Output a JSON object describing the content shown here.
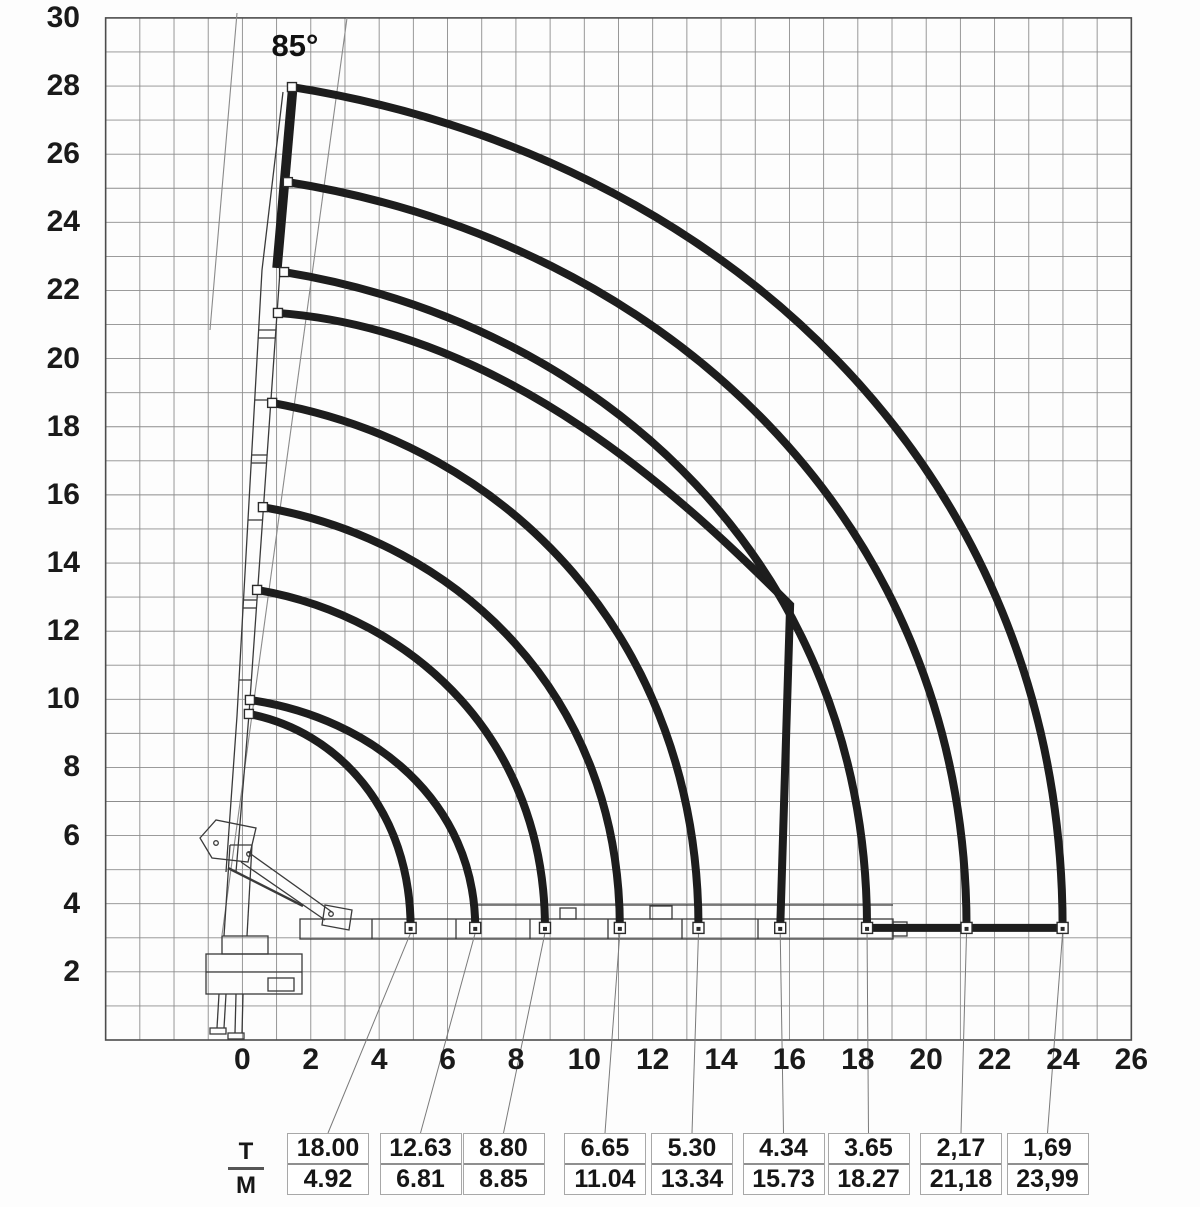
{
  "angle_label": "85°",
  "legend": {
    "numerator": "T",
    "denominator": "M"
  },
  "axes": {
    "x_tick_labels": [
      "0",
      "2",
      "4",
      "6",
      "8",
      "10",
      "12",
      "14",
      "16",
      "18",
      "20",
      "22",
      "24",
      "26"
    ],
    "x_tick_values": [
      0,
      2,
      4,
      6,
      8,
      10,
      12,
      14,
      16,
      18,
      20,
      22,
      24,
      26
    ],
    "y_tick_labels": [
      "30",
      "28",
      "26",
      "24",
      "22",
      "20",
      "18",
      "16",
      "14",
      "12",
      "10",
      "8",
      "6",
      "4",
      "2"
    ],
    "y_tick_values": [
      30,
      28,
      26,
      24,
      22,
      20,
      18,
      16,
      14,
      12,
      10,
      8,
      6,
      4,
      2
    ]
  },
  "chart_data": {
    "type": "line",
    "description": "Loader crane lifting capacity envelope diagram: nested load curves (capacity in tonnes over outreach in metres) for boom raised to 85 degrees",
    "boom_angle_label": "85°",
    "boom_angle_deg": 85,
    "x_range_m": [
      -4,
      26
    ],
    "y_range_m": [
      0,
      30
    ],
    "grid": true,
    "grid_step_m": 1,
    "ground_line_y_m": 3.29,
    "curves": [
      {
        "capacity_t_display": "18.00",
        "outreach_m_display": "4.92",
        "capacity_t": 18.0,
        "outreach_m": 4.92,
        "top_point_m": [
          0.19,
          9.57
        ]
      },
      {
        "capacity_t_display": "12.63",
        "outreach_m_display": "6.81",
        "capacity_t": 12.63,
        "outreach_m": 6.81,
        "top_point_m": [
          0.22,
          9.98
        ]
      },
      {
        "capacity_t_display": "8.80",
        "outreach_m_display": "8.85",
        "capacity_t": 8.8,
        "outreach_m": 8.85,
        "top_point_m": [
          0.43,
          13.21
        ]
      },
      {
        "capacity_t_display": "6.65",
        "outreach_m_display": "11.04",
        "capacity_t": 6.65,
        "outreach_m": 11.04,
        "top_point_m": [
          0.6,
          15.64
        ]
      },
      {
        "capacity_t_display": "5.30",
        "outreach_m_display": "13.34",
        "capacity_t": 5.3,
        "outreach_m": 13.34,
        "top_point_m": [
          0.87,
          18.7
        ]
      },
      {
        "capacity_t_display": "4.34",
        "outreach_m_display": "15.73",
        "capacity_t": 4.34,
        "outreach_m": 15.73,
        "top_point_m": [
          1.04,
          21.34
        ],
        "corner_point_m": [
          16.02,
          12.77
        ]
      },
      {
        "capacity_t_display": "3.65",
        "outreach_m_display": "18.27",
        "capacity_t": 3.65,
        "outreach_m": 18.27,
        "top_point_m": [
          1.22,
          22.54
        ]
      },
      {
        "capacity_t_display": "2,17",
        "outreach_m_display": "21,18",
        "capacity_t": 2.17,
        "outreach_m": 21.18,
        "top_point_m": [
          1.33,
          25.18
        ]
      },
      {
        "capacity_t_display": "1,69",
        "outreach_m_display": "23,99",
        "capacity_t": 1.69,
        "outreach_m": 23.99,
        "top_point_m": [
          1.45,
          27.97
        ]
      }
    ],
    "ground_segment_m": {
      "from_x": 18.27,
      "to_x": 23.99,
      "y": 3.29
    }
  },
  "table": {
    "unit_top": "T",
    "unit_bottom": "M",
    "entries": [
      {
        "t": "18.00",
        "m": "4.92"
      },
      {
        "t": "12.63",
        "m": "6.81"
      },
      {
        "t": "8.80",
        "m": "8.85"
      },
      {
        "t": "6.65",
        "m": "11.04"
      },
      {
        "t": "5.30",
        "m": "13.34"
      },
      {
        "t": "4.34",
        "m": "15.73"
      },
      {
        "t": "3.65",
        "m": "18.27"
      },
      {
        "t": "2,17",
        "m": "21,18"
      },
      {
        "t": "1,69",
        "m": "23,99"
      }
    ]
  }
}
